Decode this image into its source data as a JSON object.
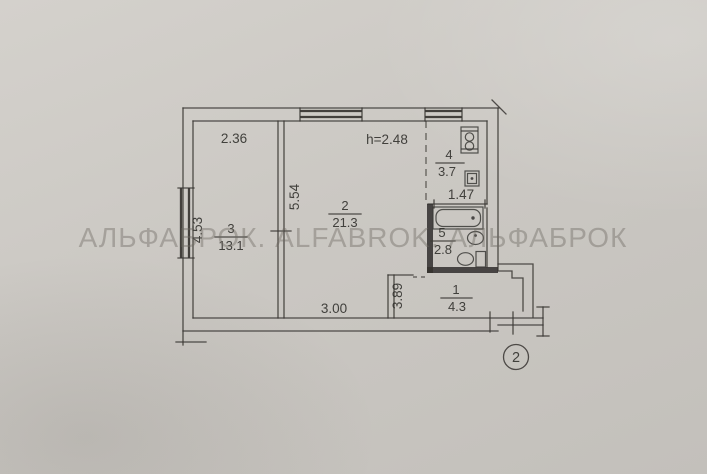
{
  "watermark": "АЛЬФАБРОК. ALFABROK. АЛЬФАБРОК",
  "sheet_number": "2",
  "dimensions": {
    "bedroom_width": "2.36",
    "ceiling_height_note": "h=2.48",
    "left_wall_height": "4.53",
    "room_depth": "5.54",
    "living_width": "3.00",
    "hall_depth": "3.89",
    "kitchen_width": "1.47"
  },
  "rooms": {
    "hallway": {
      "number": "1",
      "area": "4.3"
    },
    "living": {
      "number": "2",
      "area": "21.3"
    },
    "bedroom": {
      "number": "3",
      "area": "13.1"
    },
    "kitchen": {
      "number": "4",
      "area": "3.7"
    },
    "bathroom": {
      "number": "5",
      "area": "2.8"
    }
  },
  "fixtures": [
    "stove-icon",
    "kitchen-sink-icon",
    "bathtub-icon",
    "washbasin-icon",
    "toilet-icon"
  ],
  "colors": {
    "paper": "#cbc8c3",
    "line": "#3b3936",
    "watermark": "#6e6961"
  }
}
